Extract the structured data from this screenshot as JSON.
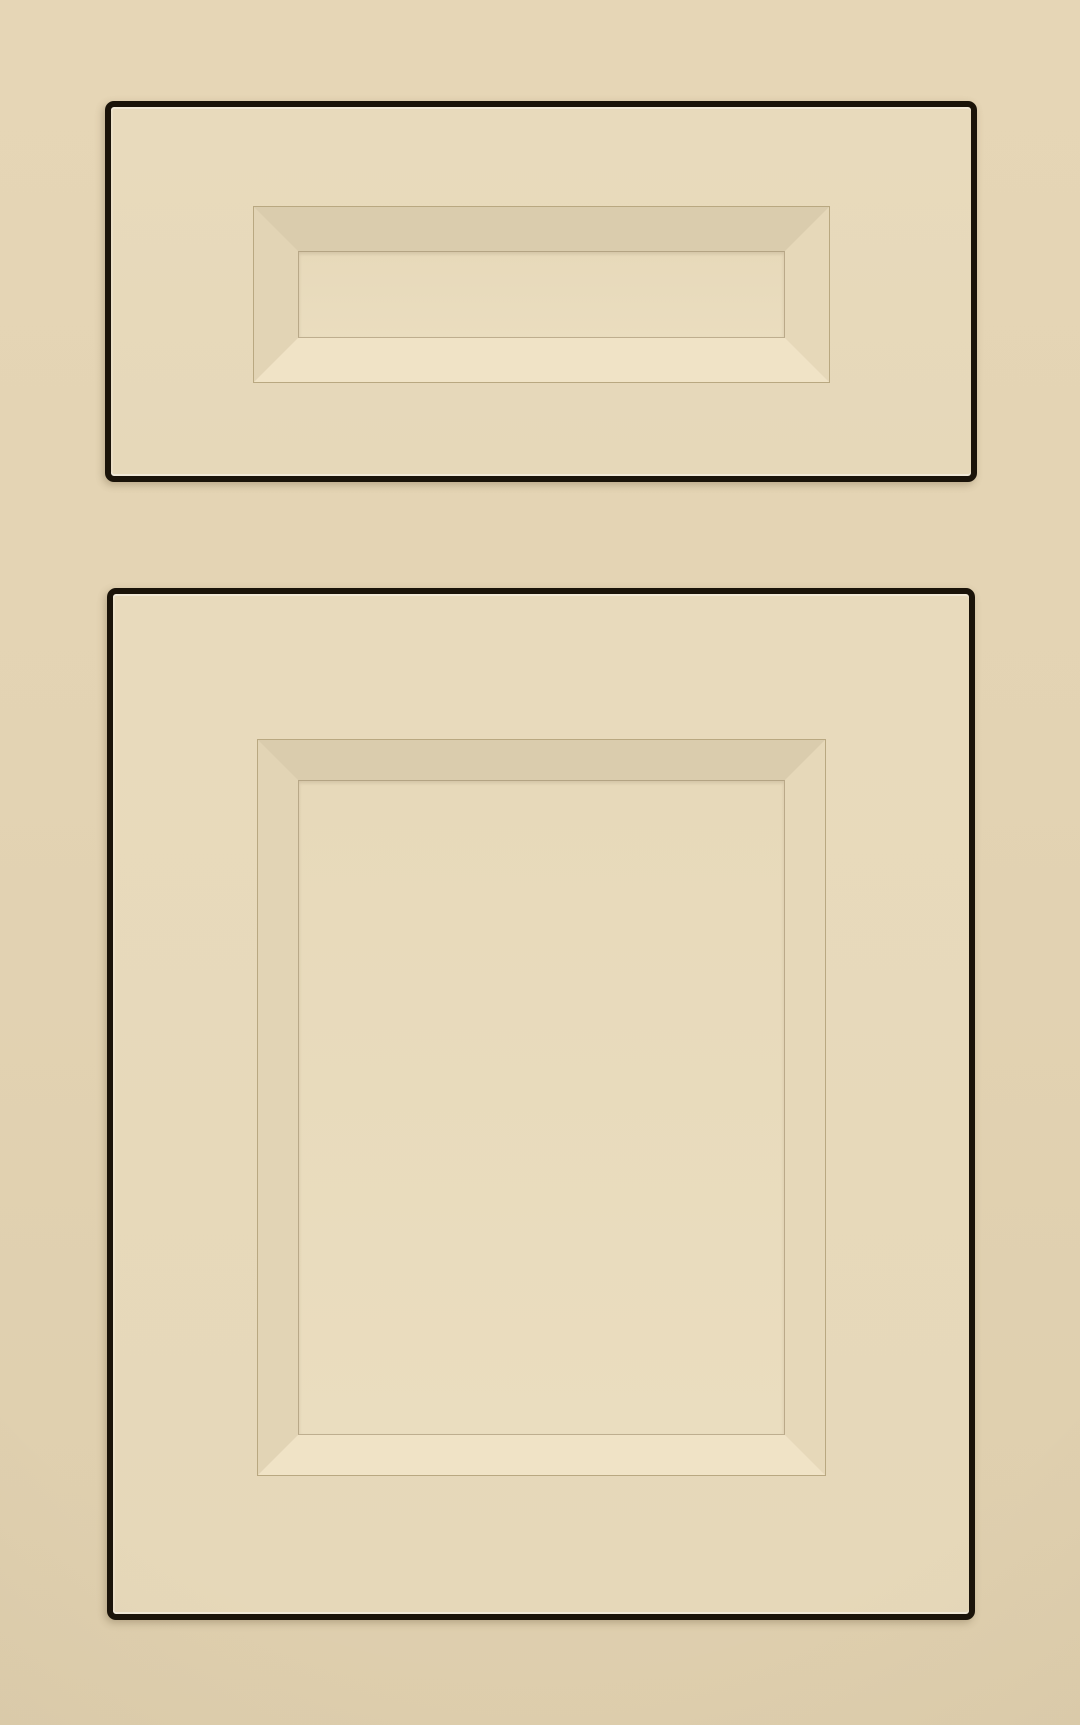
{
  "scene": {
    "subject": "Painted cabinet sample photo",
    "finish": "cream paint with dark outlined edges",
    "objects": [
      {
        "name": "drawer-front",
        "style": "recessed beveled center panel"
      },
      {
        "name": "cabinet-door",
        "style": "recessed beveled center panel"
      }
    ]
  },
  "colors": {
    "background": "#E3D3B3",
    "panel_face": "#E8DABC",
    "edge_outline": "#1A1309",
    "bevel_top": "#DACCAD",
    "bevel_right": "#E6D8B9",
    "bevel_bottom": "#F0E3C6",
    "bevel_left": "#E2D4B5",
    "inner_panel": "#E7D9BA",
    "crease_line": "#B9A881"
  }
}
